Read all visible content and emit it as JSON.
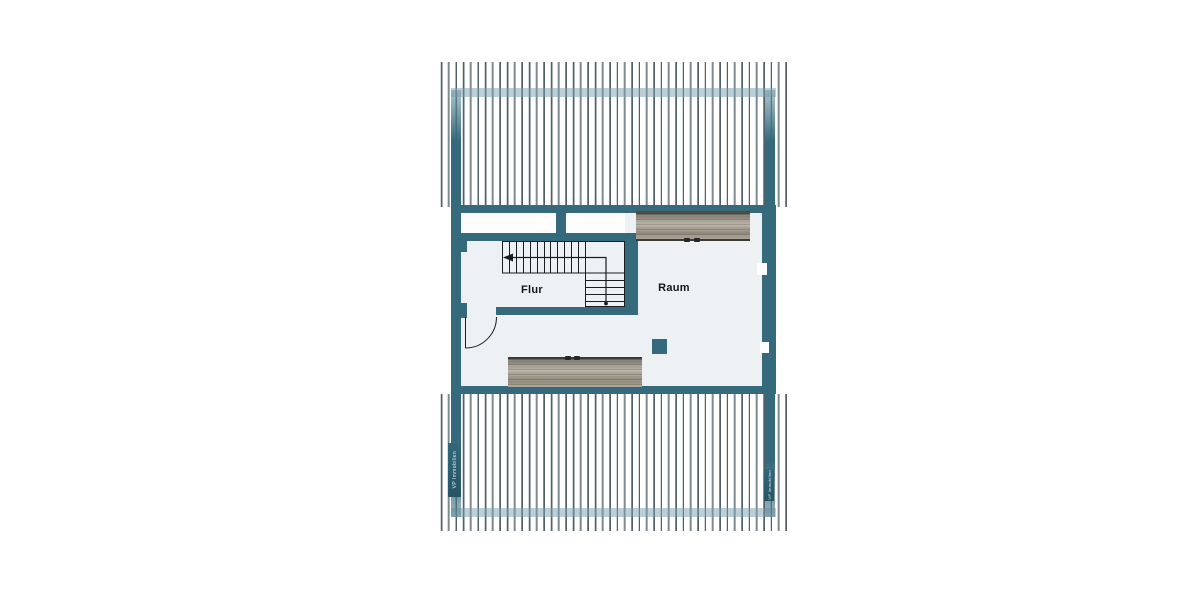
{
  "floorplan": {
    "rooms": [
      {
        "label": "Flur"
      },
      {
        "label": "Raum"
      }
    ],
    "watermarks": {
      "left": "VP Immobilien",
      "right": "VP Immobilien"
    },
    "colors": {
      "wall_teal": "#35697c",
      "room_fill": "#eef1f4",
      "hatch_line": "#52606a",
      "band_overlay": "#7fa3b3",
      "wood_light": "#bab4a7",
      "wood_dark": "#75726a",
      "stair_line": "#1c1c1c",
      "background": "#ffffff"
    }
  }
}
